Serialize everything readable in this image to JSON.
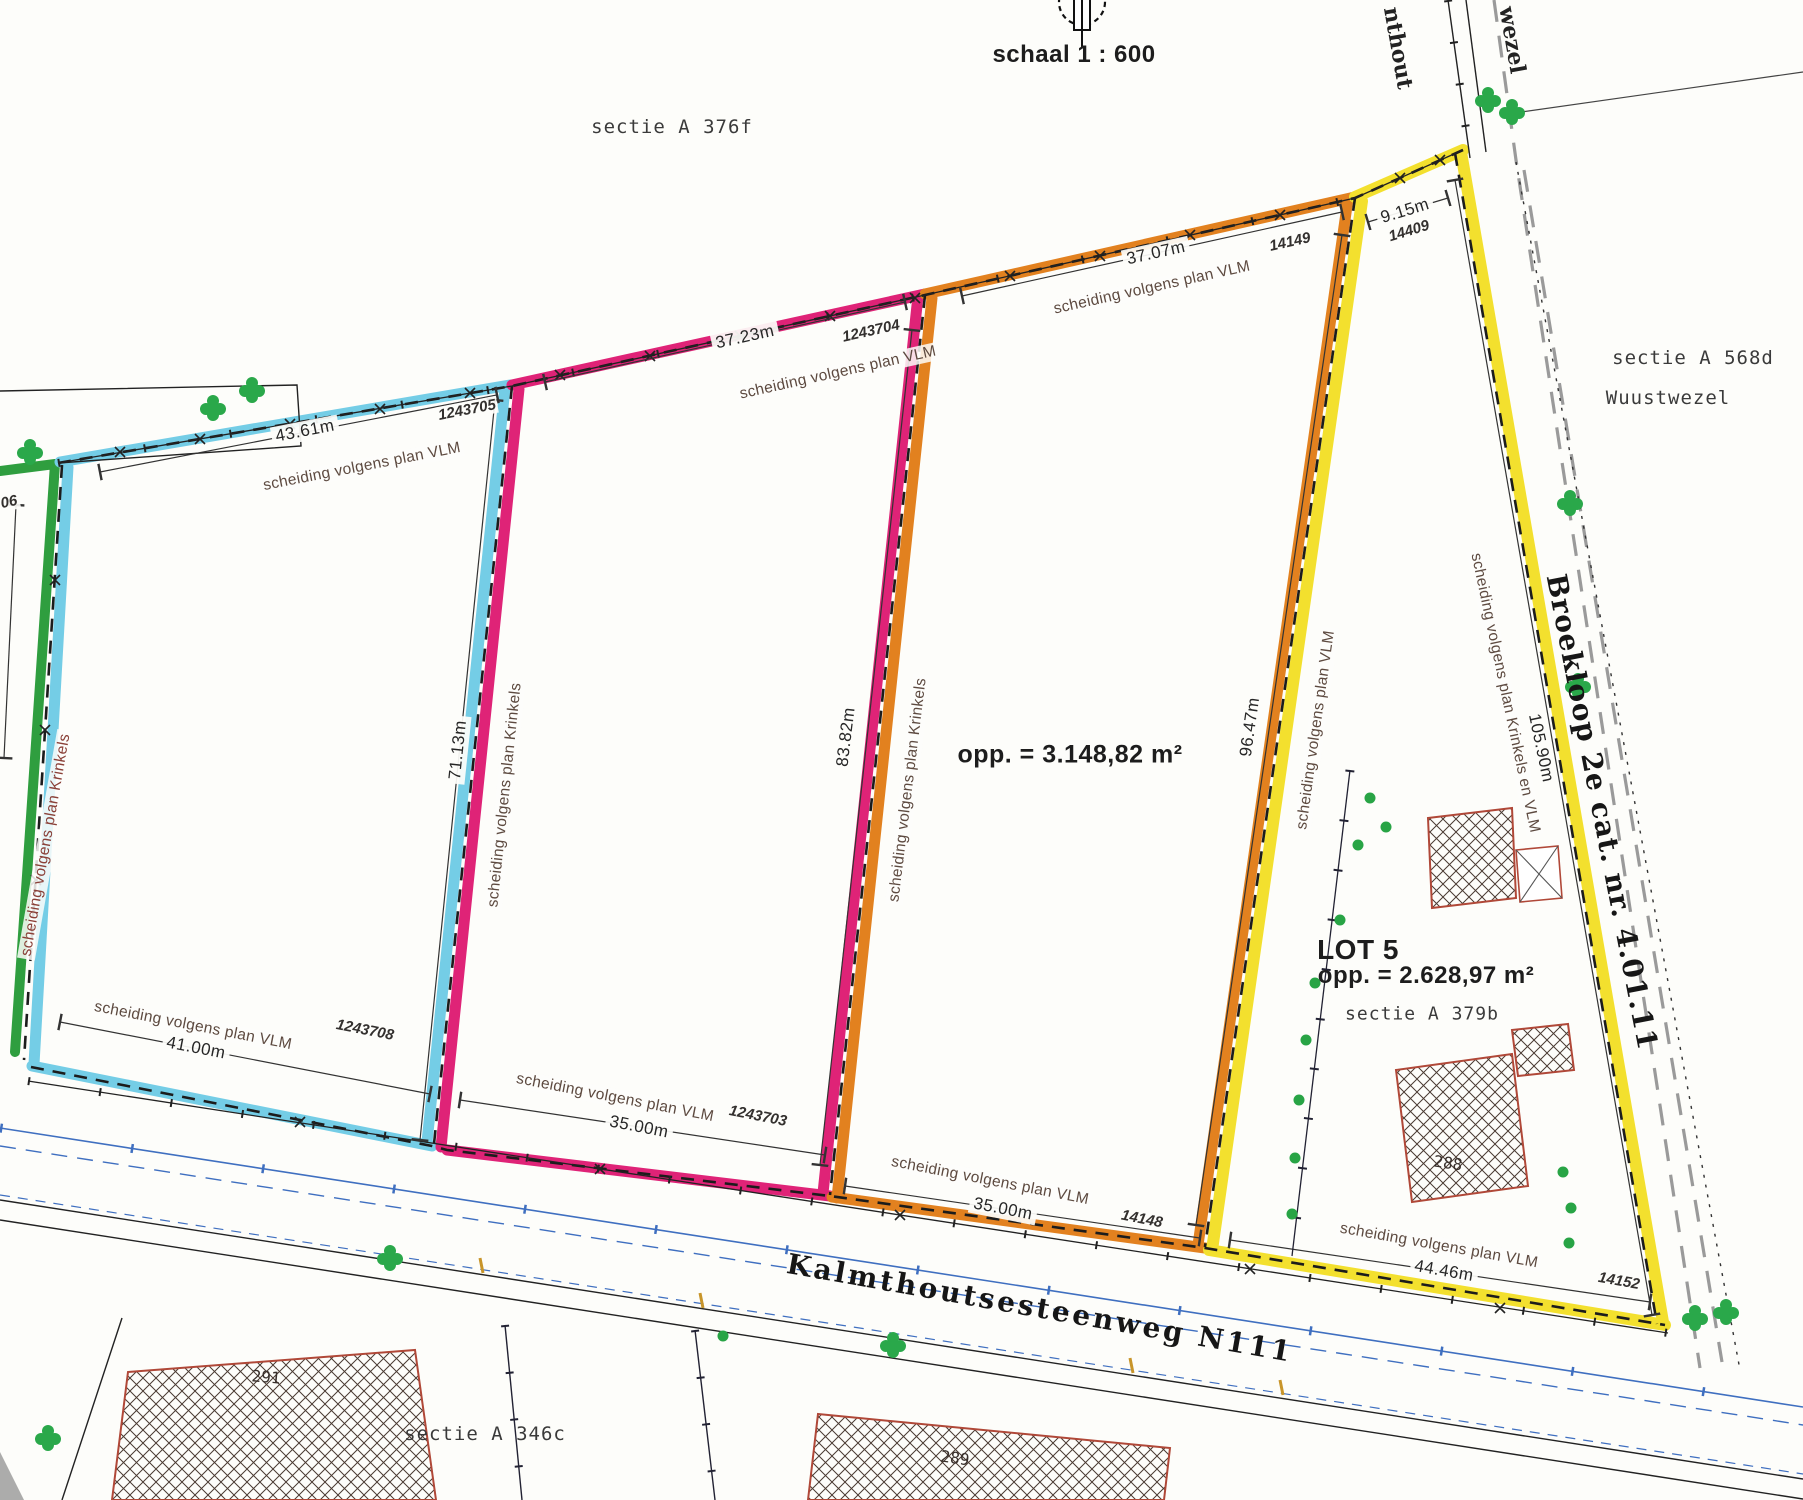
{
  "header": {
    "scale_label": "schaal 1 : 600",
    "north_icon": "north-arrow-compass-icon"
  },
  "sections": {
    "top_left": "sectie A 376f",
    "right": "sectie A 568d",
    "right_town": "Wuustwezel",
    "lot5": "sectie A 379b",
    "bottom_left": "sectie A 346c"
  },
  "border_fragments": {
    "kalmthout": "nthout",
    "wuustwezel": "wezel"
  },
  "roads": {
    "steenweg": "Kalmthoutsesteenweg N111",
    "broekloop": "Broekloop 2e cat. nr. 4.01.11"
  },
  "lots": {
    "middle_area": "opp. = 3.148,82 m²",
    "lot5_name": "LOT 5",
    "lot5_area": "opp. = 2.628,97 m²"
  },
  "boundary_types": {
    "vlm": "scheiding volgens plan VLM",
    "krinkels": "scheiding volgens plan Krinkels",
    "krinkels_en_vlm": "scheiding volgens plan Krinkels en VLM"
  },
  "measurements": {
    "top_cyan": {
      "length": "43.61m",
      "ref": "1243705"
    },
    "top_pink": {
      "length": "37.23m",
      "ref": "1243704"
    },
    "top_orange": {
      "length": "37.07m",
      "ref": "14149"
    },
    "top_yellow": {
      "length": "9.15m",
      "ref": "14409"
    },
    "side_cyan": "71.13m",
    "side_pink": "83.82m",
    "side_orange": "96.47m",
    "side_yellow": "105.90m",
    "bottom_cyan": {
      "length": "41.00m",
      "ref": "1243708"
    },
    "bottom_pink": {
      "length": "35.00m",
      "ref": "1243703"
    },
    "bottom_orange": {
      "length": "35.00m",
      "ref": "14148"
    },
    "bottom_yellow": {
      "length": "44.46m",
      "ref": "14152"
    },
    "left_ref_fragment": "06"
  },
  "buildings": {
    "lot5_house": "288",
    "southwest": "291",
    "south": "289"
  },
  "colors": {
    "lot_green": "#2f9e3f",
    "lot_cyan": "#74cde6",
    "lot_pink": "#df2377",
    "lot_orange": "#e2811f",
    "lot_yellow": "#f3e02e",
    "building_outline": "#b04838",
    "tree_green": "#2aa84a",
    "utility_blue": "#3f6fc0",
    "broekloop_gray": "#9a9a9a"
  }
}
